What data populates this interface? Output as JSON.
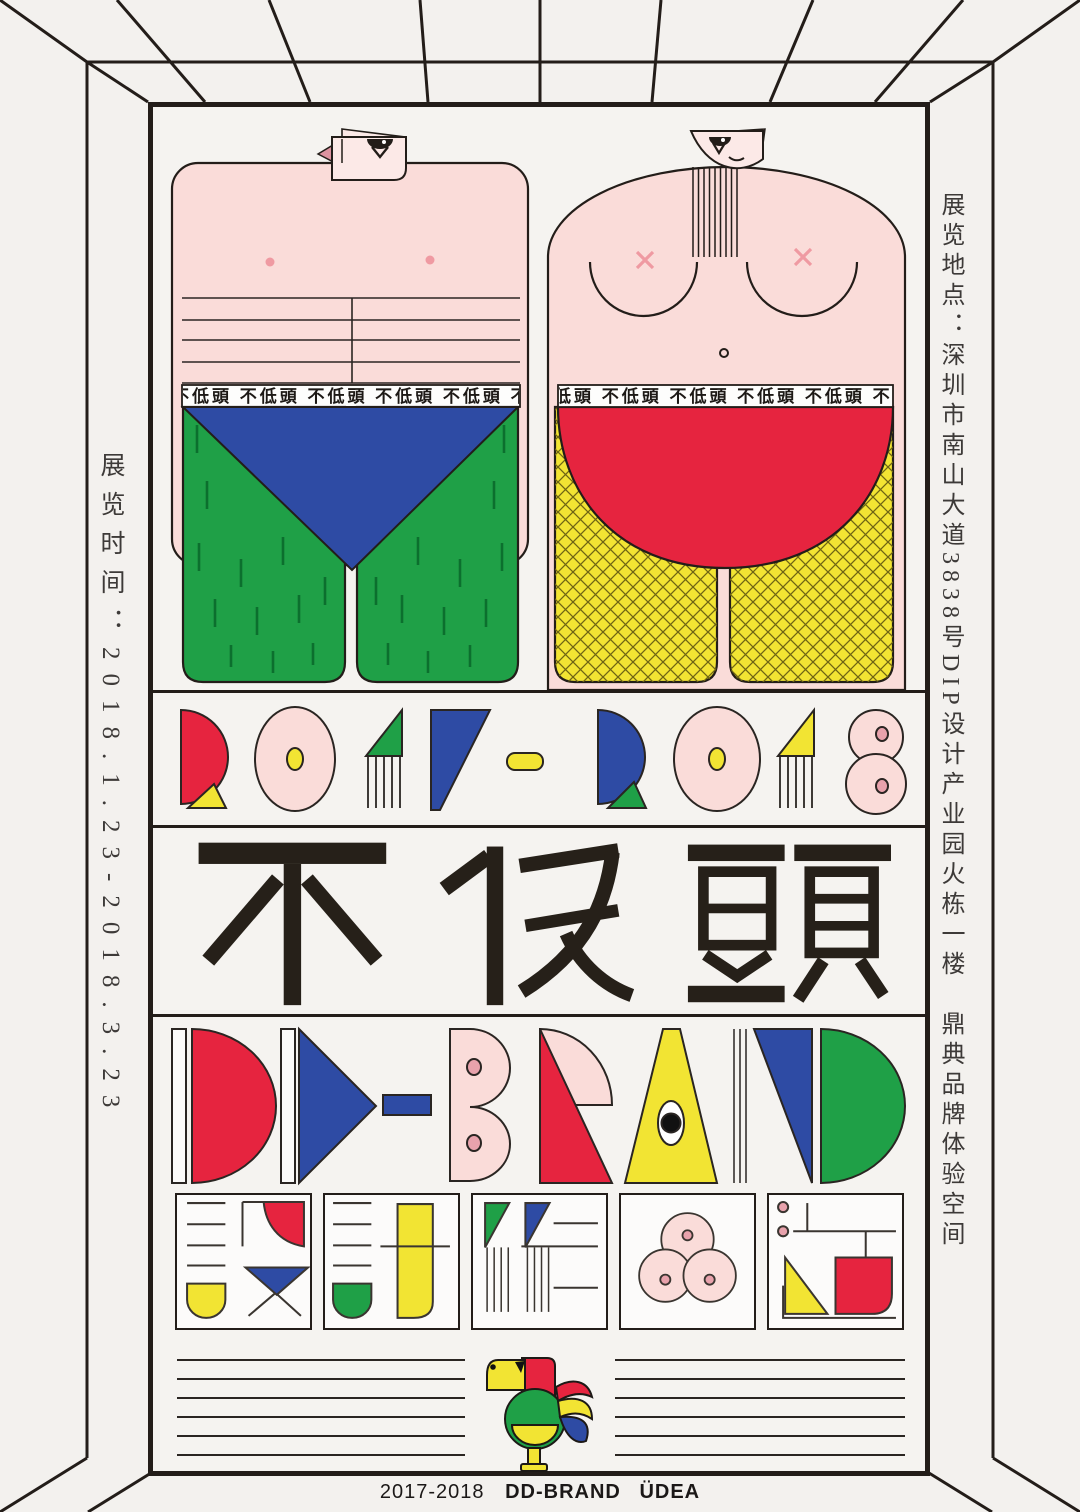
{
  "poster": {
    "background": "#f3f1ee",
    "ink": "#231d19",
    "palette": {
      "red": "#e6243f",
      "blue": "#2e4ba4",
      "green": "#1fa047",
      "yellow": "#f2e433",
      "pink_skin": "#fadcd9",
      "rose": "#ef9aa2",
      "dark_pink": "#dd93a0"
    }
  },
  "side": {
    "left_text": "展览时间：2018.1.23-2018.3.23",
    "right_text": "展览地点：深圳市南山大道3838号DIP设计产业园火栋一楼　鼎典品牌体验空间"
  },
  "figures": {
    "waistband_text": "不低頭 不低頭 不低頭 不低頭 不低頭 不低頭 不低頭"
  },
  "rows": {
    "year_range": "2017-2018",
    "title": "不低頭",
    "brand": "DD-BRAND"
  },
  "footer": {
    "year": "2017-2018",
    "brand": "DD-BRAND",
    "studio": "ÜDEA"
  }
}
